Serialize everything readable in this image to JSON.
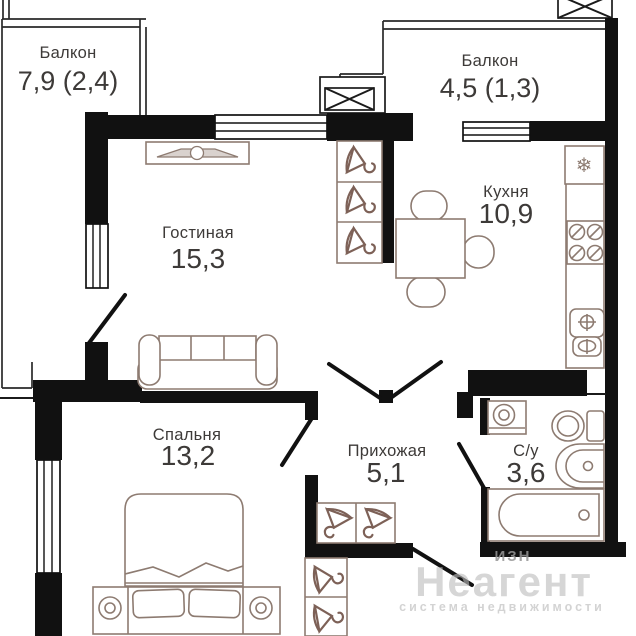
{
  "plan": {
    "rooms": {
      "balcony_left": {
        "name": "Балкон",
        "area": "7,9 (2,4)"
      },
      "balcony_right": {
        "name": "Балкон",
        "area": "4,5 (1,3)"
      },
      "living": {
        "name": "Гостиная",
        "area": "15,3"
      },
      "kitchen": {
        "name": "Кухня",
        "area": "10,9"
      },
      "bedroom": {
        "name": "Спальня",
        "area": "13,2"
      },
      "hallway": {
        "name": "Прихожая",
        "area": "5,1"
      },
      "bathroom": {
        "name": "С/у",
        "area": "3,6"
      }
    },
    "icons": {
      "fridge_snowflake": "❄"
    },
    "watermark": {
      "brand": "Неагент",
      "tagline": "система недвижимости",
      "fragment": "ИЗН"
    },
    "colors": {
      "wall": "#111111",
      "furniture": "#8d7b71",
      "text": "#3d3a38",
      "watermark": "#bdbdbd"
    }
  }
}
